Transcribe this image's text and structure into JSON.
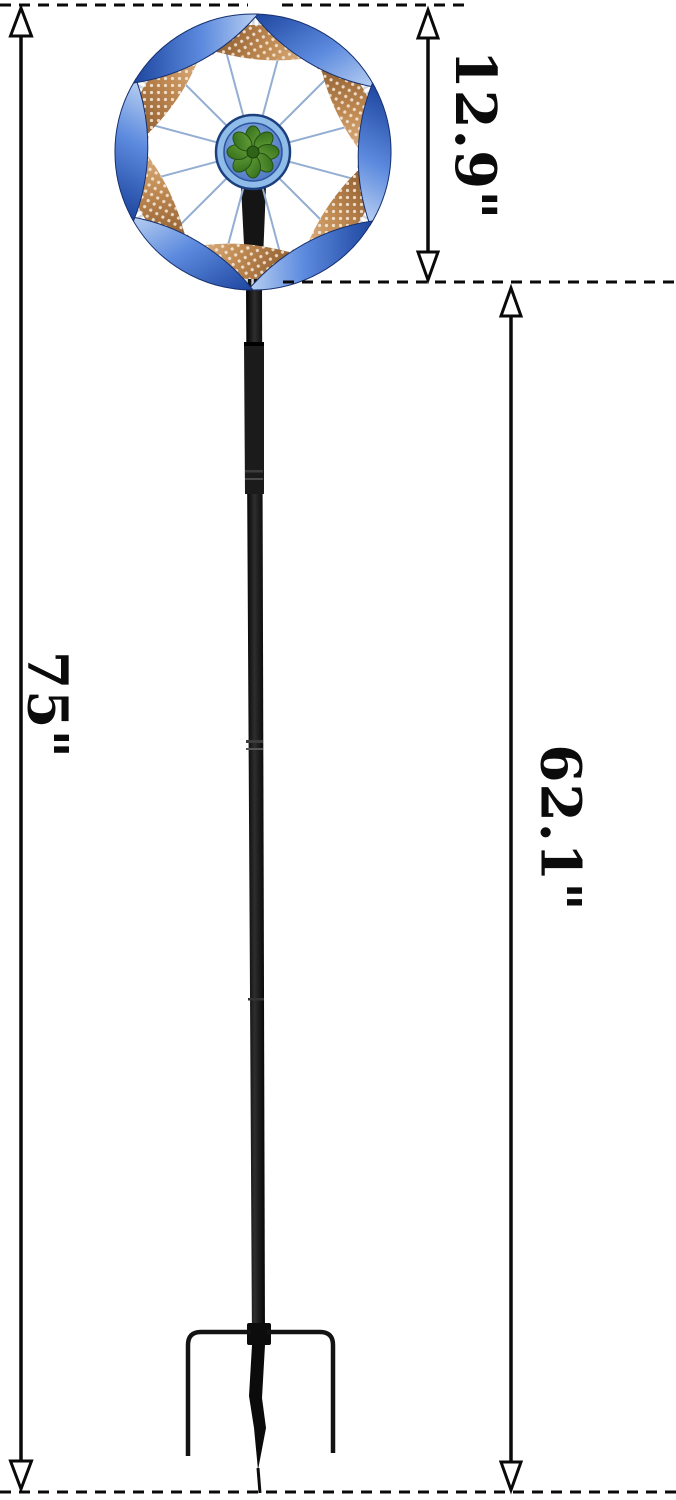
{
  "diagram": {
    "type": "product-dimension-diagram",
    "labels": {
      "spinner_height": "12.9\"",
      "total_height": "75\"",
      "stake_height": "62.1\""
    },
    "colors": {
      "dimension_line": "#0a0a0a",
      "blade_blue": "#3f6cc7",
      "blade_copper": "#b07a46",
      "lace_silver": "#d3d8df",
      "hub_blue": "#4a7fd0",
      "flower_green": "#4a8c28",
      "pole_black": "#141414",
      "background": "#ffffff"
    },
    "icons": [
      "wind-spinner",
      "dimension-arrow",
      "ground-stake",
      "flower-center"
    ]
  }
}
